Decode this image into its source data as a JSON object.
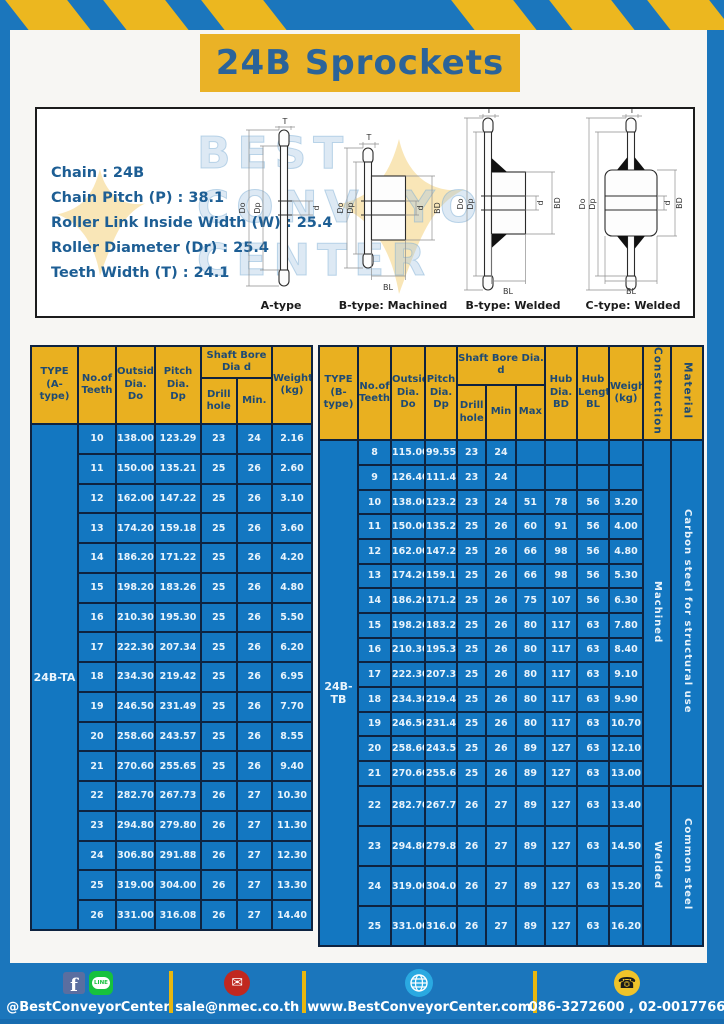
{
  "title": "24B Sprockets",
  "specs": {
    "lines": [
      "Chain : 24B",
      "Chain Pitch (P) : 38.1",
      "Roller Link Inside Width (W) : 25.4",
      "Roller Diameter (Dr) : 25.4",
      "Teeth Width (T) : 24.1"
    ]
  },
  "watermark": {
    "text": "BEST\nCONVEYOR\nCENTER"
  },
  "diagrams": {
    "labels": [
      "A-type",
      "B-type: Machined",
      "B-type: Welded",
      "C-type: Welded"
    ],
    "dims": {
      "t": "T",
      "do": "Do",
      "dp": "Dp",
      "d": "d",
      "bd": "BD",
      "bl": "BL"
    }
  },
  "table_a": {
    "type_label": "24B-TA",
    "headers": {
      "type": "TYPE\n(A-type)",
      "teeth": "No.of\nTeeth",
      "outside": "Outside\nDia.\nDo",
      "pitch": "Pitch Dia.\nDp",
      "shaft": "Shaft Bore Dia d",
      "drill": "Drill hole",
      "min": "Min.",
      "weight": "Weight\n(kg)"
    },
    "rows": [
      [
        "10",
        "138.00",
        "123.29",
        "23",
        "24",
        "2.16"
      ],
      [
        "11",
        "150.00",
        "135.21",
        "25",
        "26",
        "2.60"
      ],
      [
        "12",
        "162.00",
        "147.22",
        "25",
        "26",
        "3.10"
      ],
      [
        "13",
        "174.20",
        "159.18",
        "25",
        "26",
        "3.60"
      ],
      [
        "14",
        "186.20",
        "171.22",
        "25",
        "26",
        "4.20"
      ],
      [
        "15",
        "198.20",
        "183.26",
        "25",
        "26",
        "4.80"
      ],
      [
        "16",
        "210.30",
        "195.30",
        "25",
        "26",
        "5.50"
      ],
      [
        "17",
        "222.30",
        "207.34",
        "25",
        "26",
        "6.20"
      ],
      [
        "18",
        "234.30",
        "219.42",
        "25",
        "26",
        "6.95"
      ],
      [
        "19",
        "246.50",
        "231.49",
        "25",
        "26",
        "7.70"
      ],
      [
        "20",
        "258.60",
        "243.57",
        "25",
        "26",
        "8.55"
      ],
      [
        "21",
        "270.60",
        "255.65",
        "25",
        "26",
        "9.40"
      ],
      [
        "22",
        "282.70",
        "267.73",
        "26",
        "27",
        "10.30"
      ],
      [
        "23",
        "294.80",
        "279.80",
        "26",
        "27",
        "11.30"
      ],
      [
        "24",
        "306.80",
        "291.88",
        "26",
        "27",
        "12.30"
      ],
      [
        "25",
        "319.00",
        "304.00",
        "26",
        "27",
        "13.30"
      ],
      [
        "26",
        "331.00",
        "316.08",
        "26",
        "27",
        "14.40"
      ]
    ]
  },
  "table_b": {
    "type_label": "24B-TB",
    "headers": {
      "type": "TYPE\n(B-type)",
      "teeth": "No.of\nTeeth",
      "outside": "Outside\nDia.\nDo",
      "pitch": "Pitch\nDia.\nDp",
      "shaft": "Shaft Bore Dia.  d",
      "drill": "Drill hole",
      "min": "Min",
      "max": "Max",
      "hub_dia": "Hub\nDia.\nBD",
      "hub_len": "Hub\nLength\nBL",
      "weight": "Weight\n(kg)",
      "construction": "Construction",
      "material": "Material"
    },
    "construction": [
      {
        "label": "Machined",
        "span": 14
      },
      {
        "label": "Welded",
        "span": 4
      }
    ],
    "material": [
      {
        "label": "Carbon steel for structural use",
        "span": 14
      },
      {
        "label": "Common steel",
        "span": 4
      }
    ],
    "rows": [
      [
        "8",
        "115.00",
        "99.55",
        "23",
        "24",
        "",
        "",
        "",
        ""
      ],
      [
        "9",
        "126.40",
        "111.40",
        "23",
        "24",
        "",
        "",
        "",
        ""
      ],
      [
        "10",
        "138.00",
        "123.29",
        "23",
        "24",
        "51",
        "78",
        "56",
        "3.20"
      ],
      [
        "11",
        "150.00",
        "135.21",
        "25",
        "26",
        "60",
        "91",
        "56",
        "4.00"
      ],
      [
        "12",
        "162.00",
        "147.22",
        "25",
        "26",
        "66",
        "98",
        "56",
        "4.80"
      ],
      [
        "13",
        "174.20",
        "159.18",
        "25",
        "26",
        "66",
        "98",
        "56",
        "5.30"
      ],
      [
        "14",
        "186.20",
        "171.22",
        "25",
        "26",
        "75",
        "107",
        "56",
        "6.30"
      ],
      [
        "15",
        "198.20",
        "183.26",
        "25",
        "26",
        "80",
        "117",
        "63",
        "7.80"
      ],
      [
        "16",
        "210.30",
        "195.30",
        "25",
        "26",
        "80",
        "117",
        "63",
        "8.40"
      ],
      [
        "17",
        "222.30",
        "207.34",
        "25",
        "26",
        "80",
        "117",
        "63",
        "9.10"
      ],
      [
        "18",
        "234.30",
        "219.42",
        "25",
        "26",
        "80",
        "117",
        "63",
        "9.90"
      ],
      [
        "19",
        "246.50",
        "231.49",
        "25",
        "26",
        "80",
        "117",
        "63",
        "10.70"
      ],
      [
        "20",
        "258.60",
        "243.57",
        "25",
        "26",
        "89",
        "127",
        "63",
        "12.10"
      ],
      [
        "21",
        "270.60",
        "255.65",
        "25",
        "26",
        "89",
        "127",
        "63",
        "13.00"
      ],
      [
        "22",
        "282.70",
        "267.73",
        "26",
        "27",
        "89",
        "127",
        "63",
        "13.40"
      ],
      [
        "23",
        "294.80",
        "279.80",
        "26",
        "27",
        "89",
        "127",
        "63",
        "14.50"
      ],
      [
        "24",
        "319.00",
        "304.00",
        "26",
        "27",
        "89",
        "127",
        "63",
        "15.20"
      ],
      [
        "25",
        "331.00",
        "316.08",
        "26",
        "27",
        "89",
        "127",
        "63",
        "16.20"
      ]
    ]
  },
  "footer": {
    "facebook_letter": "f",
    "line_label": "LINE",
    "social": "@BestConveyorCenter",
    "email": "sale@nmec.co.th",
    "website": "www.BestConveyorCenter.com",
    "phone": "086-3272600 , 02-0017766"
  },
  "colors": {
    "frame_blue": "#1b76bc",
    "table_blue": "#1377c1",
    "header_yellow": "#e9b020",
    "banner_yellow": "#eab226",
    "border_dark": "#0e2340",
    "title_text": "#2b6399",
    "header_text": "#1e4a73"
  }
}
